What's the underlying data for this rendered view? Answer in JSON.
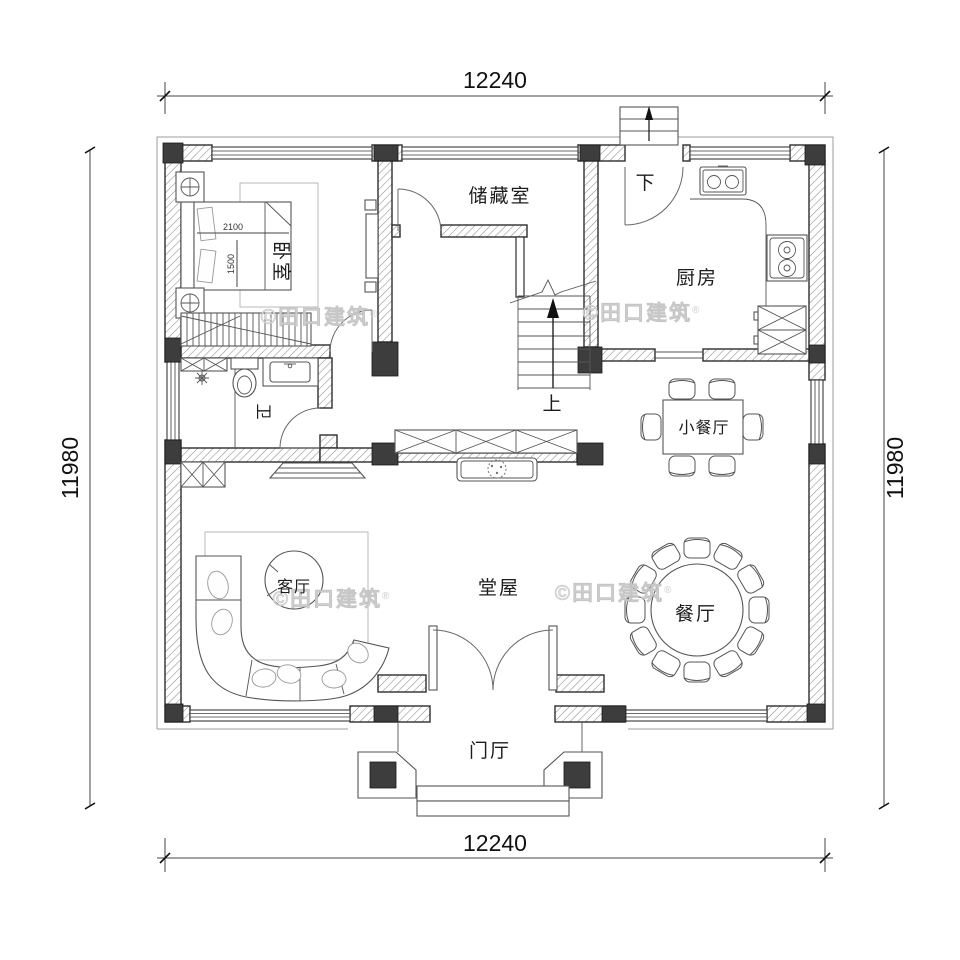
{
  "title": "residential floor plan",
  "dimensions": {
    "top": "12240",
    "bottom": "12240",
    "left": "11980",
    "right": "11980"
  },
  "rooms": {
    "bedroom": "卧室",
    "storage": "储藏室",
    "kitchen": "厨房",
    "bath": "卫",
    "small_dining": "小餐厅",
    "hall": "堂屋",
    "living": "客厅",
    "dining": "餐厅",
    "foyer": "门厅"
  },
  "stairs": {
    "up": "上",
    "down": "下"
  },
  "bed": {
    "width": "2100",
    "depth": "1500"
  },
  "watermark": "©田口建筑",
  "watermark_reg": "®",
  "colors": {
    "wall_column": "#3d3d3d",
    "wall_line": "#2e2e2e",
    "watermark": "#dcdcdc"
  }
}
